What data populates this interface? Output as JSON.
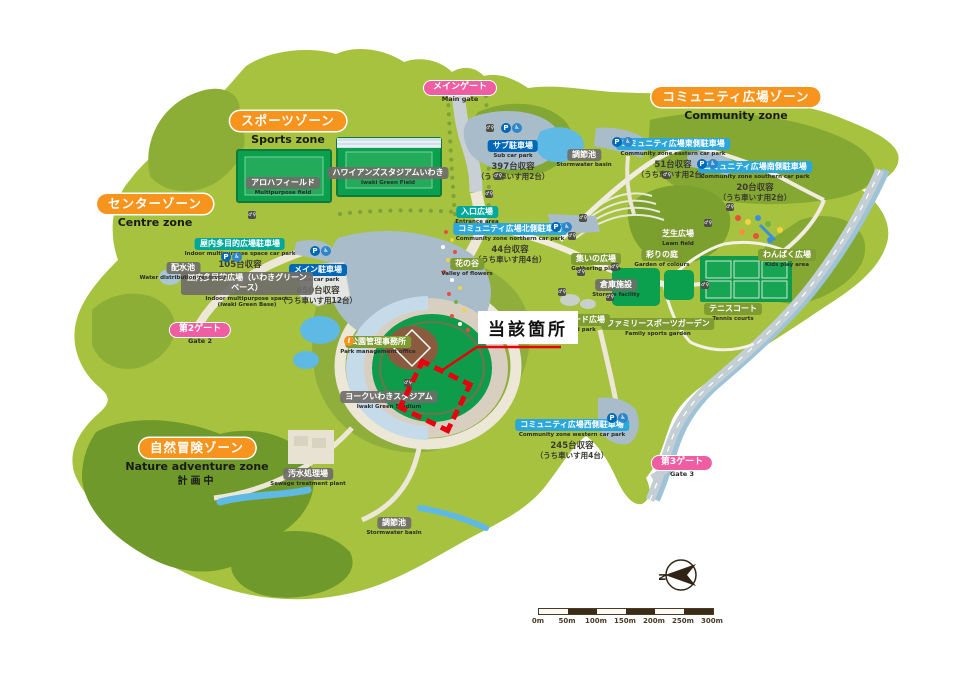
{
  "annotation": {
    "label": "当該箇所"
  },
  "compass": {
    "label": "N"
  },
  "scalebar": {
    "ticks": [
      "0m",
      "50m",
      "100m",
      "150m",
      "200m",
      "250m",
      "300m"
    ]
  },
  "colors": {
    "accent_red": "#e8000f",
    "zone_orange": "#f7941e",
    "gate_pink": "#ef5da2",
    "parking_blue": "#0068b7",
    "parking_cyan": "#2ba7dc",
    "badge_teal": "#00a89b",
    "badge_gray": "#706e69",
    "badge_olive": "#7e9c31"
  },
  "zones": [
    {
      "id": "sports",
      "label": "スポーツゾーン",
      "sub": "Sports zone",
      "x": 288,
      "y": 110
    },
    {
      "id": "centre",
      "label": "センターゾーン",
      "sub": "Centre zone",
      "x": 155,
      "y": 193
    },
    {
      "id": "community",
      "label": "コミュニティ広場ゾーン",
      "sub": "Community zone",
      "x": 736,
      "y": 86
    },
    {
      "id": "nature",
      "label": "自然冒険ゾーン",
      "sub": "Nature adventure zone",
      "note": "計画中",
      "x": 197,
      "y": 437
    }
  ],
  "gates": [
    {
      "id": "main-gate",
      "label": "メインゲート",
      "sub": "Main gate",
      "x": 460,
      "y": 74
    },
    {
      "id": "gate-2",
      "label": "第2ゲート",
      "sub": "Gate 2",
      "x": 200,
      "y": 316
    },
    {
      "id": "gate-3",
      "label": "第3ゲート",
      "sub": "Gate 3",
      "x": 682,
      "y": 449
    }
  ],
  "parkings": [
    {
      "id": "sub",
      "label": "サブ駐車場",
      "sub": "Sub car park",
      "capacity": "397台収容",
      "note": "（うち車いす用2台）",
      "color": "blue",
      "x": 513,
      "y": 133
    },
    {
      "id": "main",
      "label": "メイン駐車場",
      "sub": "Main car park",
      "capacity": "650台収容",
      "note": "（うち車いす用12台）",
      "color": "blue",
      "x": 318,
      "y": 257
    },
    {
      "id": "indoor",
      "label": "屋内多目的広場駐車場",
      "sub": "Indoor multipurpose space car park",
      "capacity": "105台収容",
      "note": "",
      "color": "teal",
      "x": 240,
      "y": 231
    },
    {
      "id": "north",
      "label": "コミュニティ広場北側駐車場",
      "sub": "Community zone northern car park",
      "capacity": "44台収容",
      "note": "（うち車いす用4台）",
      "color": "cyan",
      "x": 510,
      "y": 216
    },
    {
      "id": "east",
      "label": "コミュニティ広場東側駐車場",
      "sub": "Community zone eastern car park",
      "capacity": "51台収容",
      "note": "（うち車いす用2台）",
      "color": "cyan",
      "x": 673,
      "y": 131
    },
    {
      "id": "south",
      "label": "コミュニティ広場南側駐車場",
      "sub": "Community zone southern car park",
      "capacity": "20台収容",
      "note": "（うち車いす用2台）",
      "color": "cyan",
      "x": 755,
      "y": 154
    },
    {
      "id": "west",
      "label": "コミュニティ広場西側駐車場",
      "sub": "Community zone western car park",
      "capacity": "245台収容",
      "note": "（うち車いす用4台）",
      "color": "cyan",
      "x": 572,
      "y": 412
    }
  ],
  "facilities": [
    {
      "id": "aloha-field",
      "label": "アロハフィールド",
      "sub": "Multipurpose field",
      "x": 283,
      "y": 170
    },
    {
      "id": "hawaiians-stadium",
      "label": "ハワイアンズスタジアムいわき",
      "sub": "Iwaki Green Field",
      "x": 388,
      "y": 160
    },
    {
      "id": "green-base",
      "label": "屋内多目的広場（いわきグリーンベース）",
      "sub": "Indoor multipurpose space (Iwaki Green Base)",
      "x": 247,
      "y": 272,
      "w": 122,
      "ew": 100
    },
    {
      "id": "york-stadium",
      "label": "ヨークいわきスタジアム",
      "sub": "Iwaki Green Stadium",
      "x": 389,
      "y": 384
    },
    {
      "id": "reservoir",
      "label": "配水池",
      "sub": "Water distribution reservoir",
      "x": 183,
      "y": 255
    },
    {
      "id": "sewage",
      "label": "汚水処理場",
      "sub": "Sewage treatment plant",
      "x": 308,
      "y": 461
    },
    {
      "id": "basin-north",
      "label": "調節池",
      "sub": "Stormwater basin",
      "x": 584,
      "y": 142
    },
    {
      "id": "basin-south",
      "label": "調節池",
      "sub": "Stormwater basin",
      "x": 394,
      "y": 510
    },
    {
      "id": "storage",
      "label": "倉庫施設",
      "sub": "Storage facility",
      "x": 616,
      "y": 272
    }
  ],
  "places": [
    {
      "id": "entrance",
      "label": "入口広場",
      "sub": "Entrance area",
      "color": "teal",
      "x": 477,
      "y": 199
    },
    {
      "id": "flower-valley",
      "label": "花の谷",
      "sub": "Valley of flowers",
      "color": "olive",
      "x": 467,
      "y": 251
    },
    {
      "id": "lawn",
      "label": "芝生広場",
      "sub": "Lawn field",
      "color": "olive",
      "x": 678,
      "y": 221
    },
    {
      "id": "colour-garden",
      "label": "彩りの庭",
      "sub": "Garden of colours",
      "color": "olive",
      "x": 662,
      "y": 242
    },
    {
      "id": "gathering",
      "label": "集いの広場",
      "sub": "Gathering place",
      "color": "olive",
      "x": 596,
      "y": 246
    },
    {
      "id": "kids",
      "label": "わんぱく広場",
      "sub": "Kids play area",
      "color": "olive",
      "x": 787,
      "y": 242
    },
    {
      "id": "tennis",
      "label": "テニスコート",
      "sub": "Tennis courts",
      "color": "olive",
      "x": 733,
      "y": 296
    },
    {
      "id": "family-garden",
      "label": "ファミリースポーツガーデン",
      "sub": "Family sports garden",
      "color": "olive",
      "x": 658,
      "y": 311
    },
    {
      "id": "skate",
      "label": "スケートボード広場",
      "sub": "Skate board park",
      "color": "olive",
      "x": 569,
      "y": 307
    },
    {
      "id": "office",
      "label": "公園管理事務所",
      "sub": "Park management office",
      "color": "olive",
      "x": 378,
      "y": 329
    }
  ],
  "info_icon": {
    "x": 349,
    "y": 341
  },
  "parking_icons": [
    {
      "x": 506,
      "y": 128
    },
    {
      "x": 315,
      "y": 251
    },
    {
      "x": 226,
      "y": 257
    },
    {
      "x": 556,
      "y": 227
    },
    {
      "x": 617,
      "y": 142
    },
    {
      "x": 702,
      "y": 164
    },
    {
      "x": 612,
      "y": 418
    }
  ],
  "toilets": [
    {
      "x": 490,
      "y": 128
    },
    {
      "x": 498,
      "y": 176
    },
    {
      "x": 489,
      "y": 194
    },
    {
      "x": 583,
      "y": 218
    },
    {
      "x": 572,
      "y": 236
    },
    {
      "x": 581,
      "y": 272
    },
    {
      "x": 562,
      "y": 292
    },
    {
      "x": 610,
      "y": 297
    },
    {
      "x": 615,
      "y": 267
    },
    {
      "x": 705,
      "y": 285
    },
    {
      "x": 730,
      "y": 207
    },
    {
      "x": 708,
      "y": 223
    },
    {
      "x": 667,
      "y": 175
    },
    {
      "x": 252,
      "y": 215
    },
    {
      "x": 408,
      "y": 383
    }
  ]
}
